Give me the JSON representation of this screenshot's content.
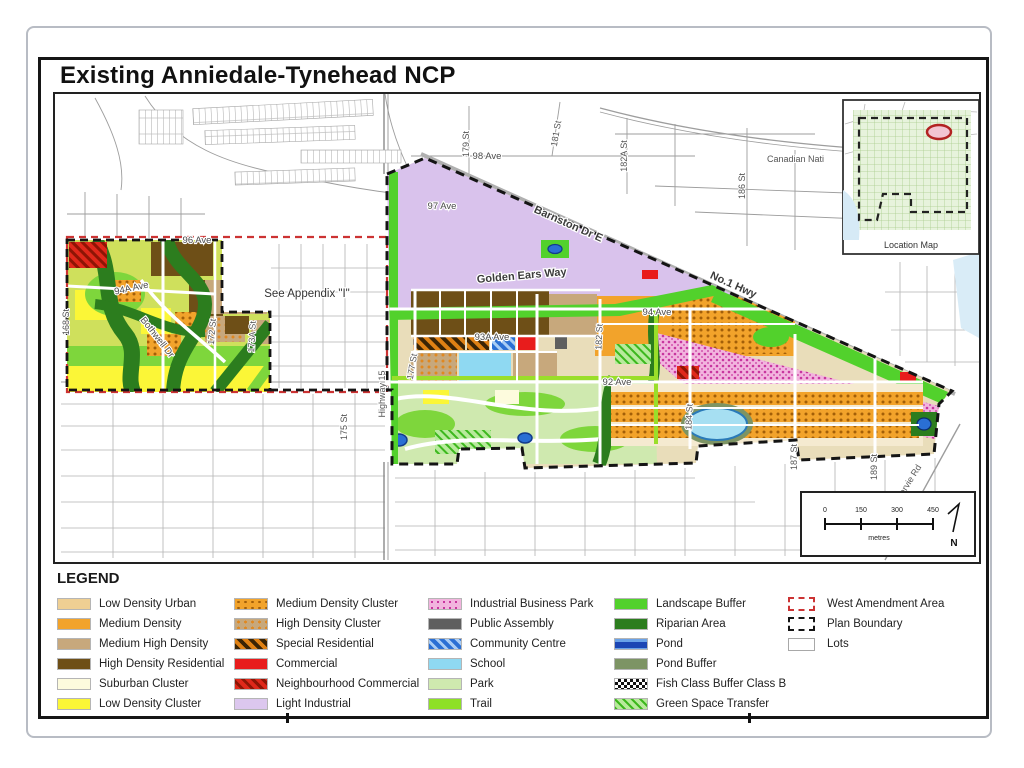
{
  "page": {
    "title": "Existing Anniedale-Tynehead NCP"
  },
  "map": {
    "labels": {
      "ave98": "98 Ave",
      "ave97": "97 Ave",
      "ave96": "96 Ave",
      "ave94a": "94A Ave",
      "ave94": "94 Ave",
      "ave93a": "93A Ave",
      "ave92": "92 Ave",
      "st168": "168 St",
      "st172": "172 St",
      "st173a": "173A St",
      "st175": "175 St",
      "st177": "177 St",
      "st179": "179 St",
      "st181": "181 St",
      "st182": "182 St",
      "st182a": "182A St",
      "st184": "184 St",
      "st186": "186 St",
      "st187": "187 St",
      "st189": "189 St",
      "hwy15": "Highway 15",
      "barnston": "Barnston Dr E",
      "golden_ears": "Golden Ears Way",
      "no1_hwy": "No.1 Hwy",
      "bothwell": "Bothwell Dr",
      "harvie": "Harvie Rd",
      "cn_rail": "Canadian Nati",
      "appendix": "See Appendix \"I\""
    },
    "inset": {
      "caption": "Location Map"
    },
    "scale": {
      "ticks": [
        "0",
        "150",
        "300",
        "450"
      ],
      "unit": "metres",
      "north": "N"
    }
  },
  "legend": {
    "title": "LEGEND",
    "columns": [
      {
        "items": [
          {
            "label": "Low Density Urban",
            "color": "#efcf93"
          },
          {
            "label": "Medium Density",
            "color": "#f2a32b"
          },
          {
            "label": "Medium High Density",
            "color": "#c7a87c"
          },
          {
            "label": "High Density Residential",
            "color": "#6e4f17"
          },
          {
            "label": "Suburban Cluster",
            "color": "#fdfbdd"
          },
          {
            "label": "Low Density Cluster",
            "color": "#fbf637"
          }
        ]
      },
      {
        "items": [
          {
            "label": "Medium Density Cluster",
            "color": "#f2a32b"
          },
          {
            "label": "High Density Cluster",
            "color": "#c7a87c"
          },
          {
            "label": "Special Residential",
            "color": "#e08114"
          },
          {
            "label": "Commercial",
            "color": "#e81c1c"
          },
          {
            "label": "Neighbourhood Commercial",
            "color": "#e0281a"
          },
          {
            "label": "Light Industrial",
            "color": "#dcc7ee"
          }
        ]
      },
      {
        "items": [
          {
            "label": "Industrial Business Park",
            "color": "#f2b4de"
          },
          {
            "label": "Public Assembly",
            "color": "#5f5f5f"
          },
          {
            "label": "Community Centre",
            "color": "#2a6fd4"
          },
          {
            "label": "School",
            "color": "#8fd9f2"
          },
          {
            "label": "Park",
            "color": "#cfe9af"
          },
          {
            "label": "Trail",
            "color": "#8ee026"
          }
        ]
      },
      {
        "items": [
          {
            "label": "Landscape Buffer",
            "color": "#52d12c"
          },
          {
            "label": "Riparian Area",
            "color": "#2c7d1e"
          },
          {
            "label": "Pond",
            "color": "#1c46b4"
          },
          {
            "label": "Pond Buffer",
            "color": "#7d9464"
          },
          {
            "label": "Fish Class Buffer Class B",
            "color": "#111111"
          },
          {
            "label": "Green Space Transfer",
            "color": "#3db81e"
          }
        ]
      },
      {
        "items": [
          {
            "label": "West Amendment Area",
            "color": "#cc3333"
          },
          {
            "label": "Plan Boundary",
            "color": "#141414"
          },
          {
            "label": "Lots",
            "color": "#ffffff"
          }
        ]
      }
    ]
  }
}
